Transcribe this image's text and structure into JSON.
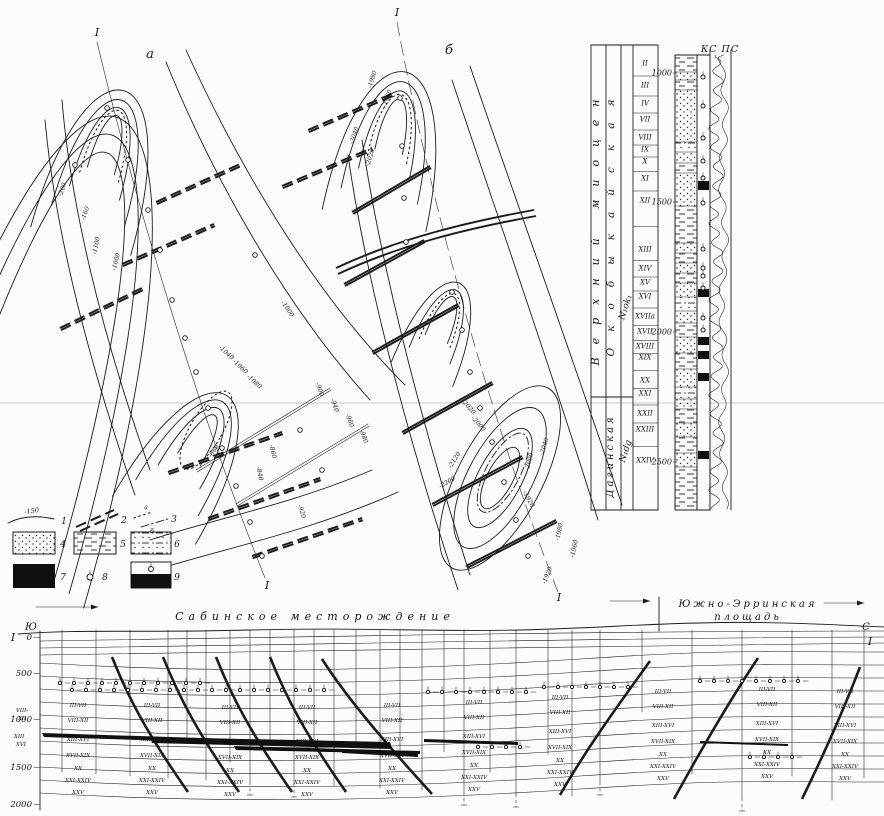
{
  "maps": {
    "a": {
      "label": "а",
      "section_label": "I",
      "contour_labels": [
        "-200",
        "-160",
        "-1100",
        "-1000",
        "-1060",
        "-1040",
        "-1080",
        "-900",
        "-940",
        "-960",
        "-980",
        "-840",
        "-860",
        "-880",
        "-920"
      ]
    },
    "b": {
      "label": "б",
      "section_label": "I",
      "contour_labels": [
        "-1980",
        "-1960",
        "-2040",
        "-2020",
        "-2120",
        "-2200",
        "-2000",
        "-1920"
      ]
    }
  },
  "strat_column": {
    "log_header": "КС ПС",
    "stage_label": "Верхний миоцен",
    "suites": [
      {
        "name": "Окобыкайская",
        "code": "N₁ok₁"
      },
      {
        "name": "Дагинская",
        "code": "N₁dg"
      }
    ],
    "depth_labels": [
      "1000",
      "1500",
      "2000",
      "2500"
    ],
    "layer_labels": [
      "II",
      "III",
      "IV",
      "VII",
      "VIII",
      "IX",
      "X",
      "XI",
      "XII",
      "XIII",
      "XIV",
      "XV",
      "XVI",
      "XVIIа",
      "XVII",
      "XVIII",
      "XIX",
      "XX",
      "XXI",
      "XXII",
      "XXIII",
      "XXIV"
    ]
  },
  "legend": {
    "items": [
      {
        "num": "1",
        "symbol": "structural-contour",
        "text": "-150"
      },
      {
        "num": "2",
        "symbol": "fault-line"
      },
      {
        "num": "3",
        "symbol": "fluid-contact-line",
        "label_a": "а",
        "label_b": "б"
      },
      {
        "num": "4",
        "symbol": "sandstone"
      },
      {
        "num": "5",
        "symbol": "clay"
      },
      {
        "num": "6",
        "symbol": "sandy-clay"
      },
      {
        "num": "7",
        "symbol": "oil-saturated-bed"
      },
      {
        "num": "8",
        "symbol": "gas-show"
      },
      {
        "num": "9",
        "symbol": "bed-with-gas-cap"
      }
    ]
  },
  "cross_section": {
    "title_left": "Сабинское месторождение",
    "title_right_lines": [
      "Южно-Эрринская",
      "площадь"
    ],
    "south_label": "Ю",
    "north_label": "С",
    "section_mark": "I",
    "depth_ticks": [
      "0",
      "500",
      "1000",
      "1500",
      "2000"
    ],
    "unit_labels": [
      "III-VII",
      "VIII-XII",
      "XIII-XVI",
      "XVII-XIX",
      "XX",
      "XXI-XXIV",
      "XXV"
    ],
    "edge_labels": [
      [
        "VIII-",
        "XII"
      ],
      [
        "XIII",
        "XVI"
      ]
    ]
  }
}
